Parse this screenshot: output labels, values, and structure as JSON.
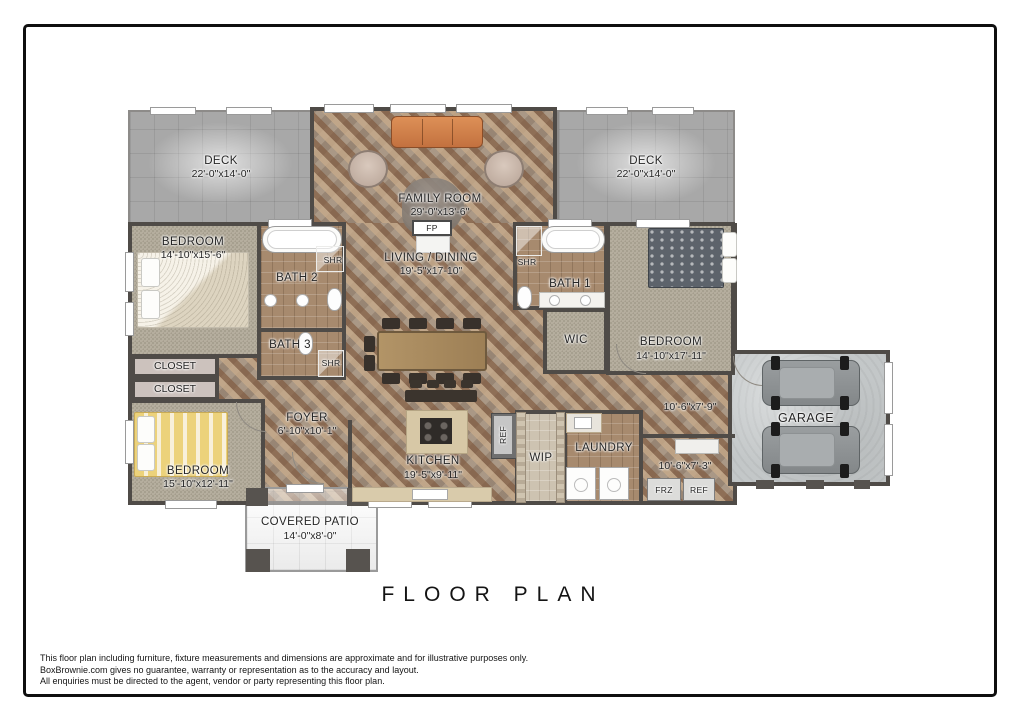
{
  "title": "FLOOR PLAN",
  "disclaimer": {
    "line1": "This floor plan including furniture, fixture measurements and dimensions are approximate and for illustrative purposes only.",
    "line2": "BoxBrownie.com gives no guarantee, warranty or representation as to the accuracy and layout.",
    "line3": "All enquiries must be directed to the agent, vendor or party representing this floor plan."
  },
  "rooms": {
    "deck_left": {
      "name": "DECK",
      "dims": "22'-0\"x14'-0\""
    },
    "deck_right": {
      "name": "DECK",
      "dims": "22'-0\"x14'-0\""
    },
    "family_room": {
      "name": "FAMILY ROOM",
      "dims": "29'-0\"x13'-6\""
    },
    "living_dining": {
      "name": "LIVING / DINING",
      "dims": "19'-5\"x17-10\""
    },
    "bedroom_top_left": {
      "name": "BEDROOM",
      "dims": "14'-10\"x15'-6\""
    },
    "bedroom_bottom_left": {
      "name": "BEDROOM",
      "dims": "15'-10\"x12'-11\""
    },
    "bedroom_right": {
      "name": "BEDROOM",
      "dims": "14'-10\"x17'-11\""
    },
    "bath_1": {
      "name": "BATH 1"
    },
    "bath_2": {
      "name": "BATH 2"
    },
    "bath_3": {
      "name": "BATH 3"
    },
    "wic": {
      "name": "WIC"
    },
    "closet_upper": {
      "name": "CLOSET"
    },
    "closet_lower": {
      "name": "CLOSET"
    },
    "foyer": {
      "name": "FOYER",
      "dims": "6'-10\"x10'-1\""
    },
    "kitchen": {
      "name": "KITCHEN",
      "dims": "19'-5\"x9'-11\""
    },
    "wip": {
      "name": "WIP"
    },
    "laundry": {
      "name": "LAUNDRY"
    },
    "hall_upper": {
      "dims": "10'-6\"x7'-9\""
    },
    "hall_lower": {
      "dims": "10'-6\"x7'-3\""
    },
    "garage": {
      "name": "GARAGE"
    },
    "covered_patio": {
      "name": "COVERED PATIO",
      "dims": "14'-0\"x8'-0\""
    }
  },
  "fixtures": {
    "shower": "SHR",
    "fireplace": "FP",
    "freezer": "FRZ",
    "fridge": "REF"
  },
  "colors": {
    "wall": "#4f4b47",
    "deck": "#a8a8a8",
    "wood_floor": "#9b7c63",
    "carpet": "#b5ae9e",
    "bath_tile": "#a78a6e",
    "garage_concrete": "#c3c7c8",
    "sofa_orange": "#cd8050",
    "bed_yellow": "#ecd27b"
  }
}
